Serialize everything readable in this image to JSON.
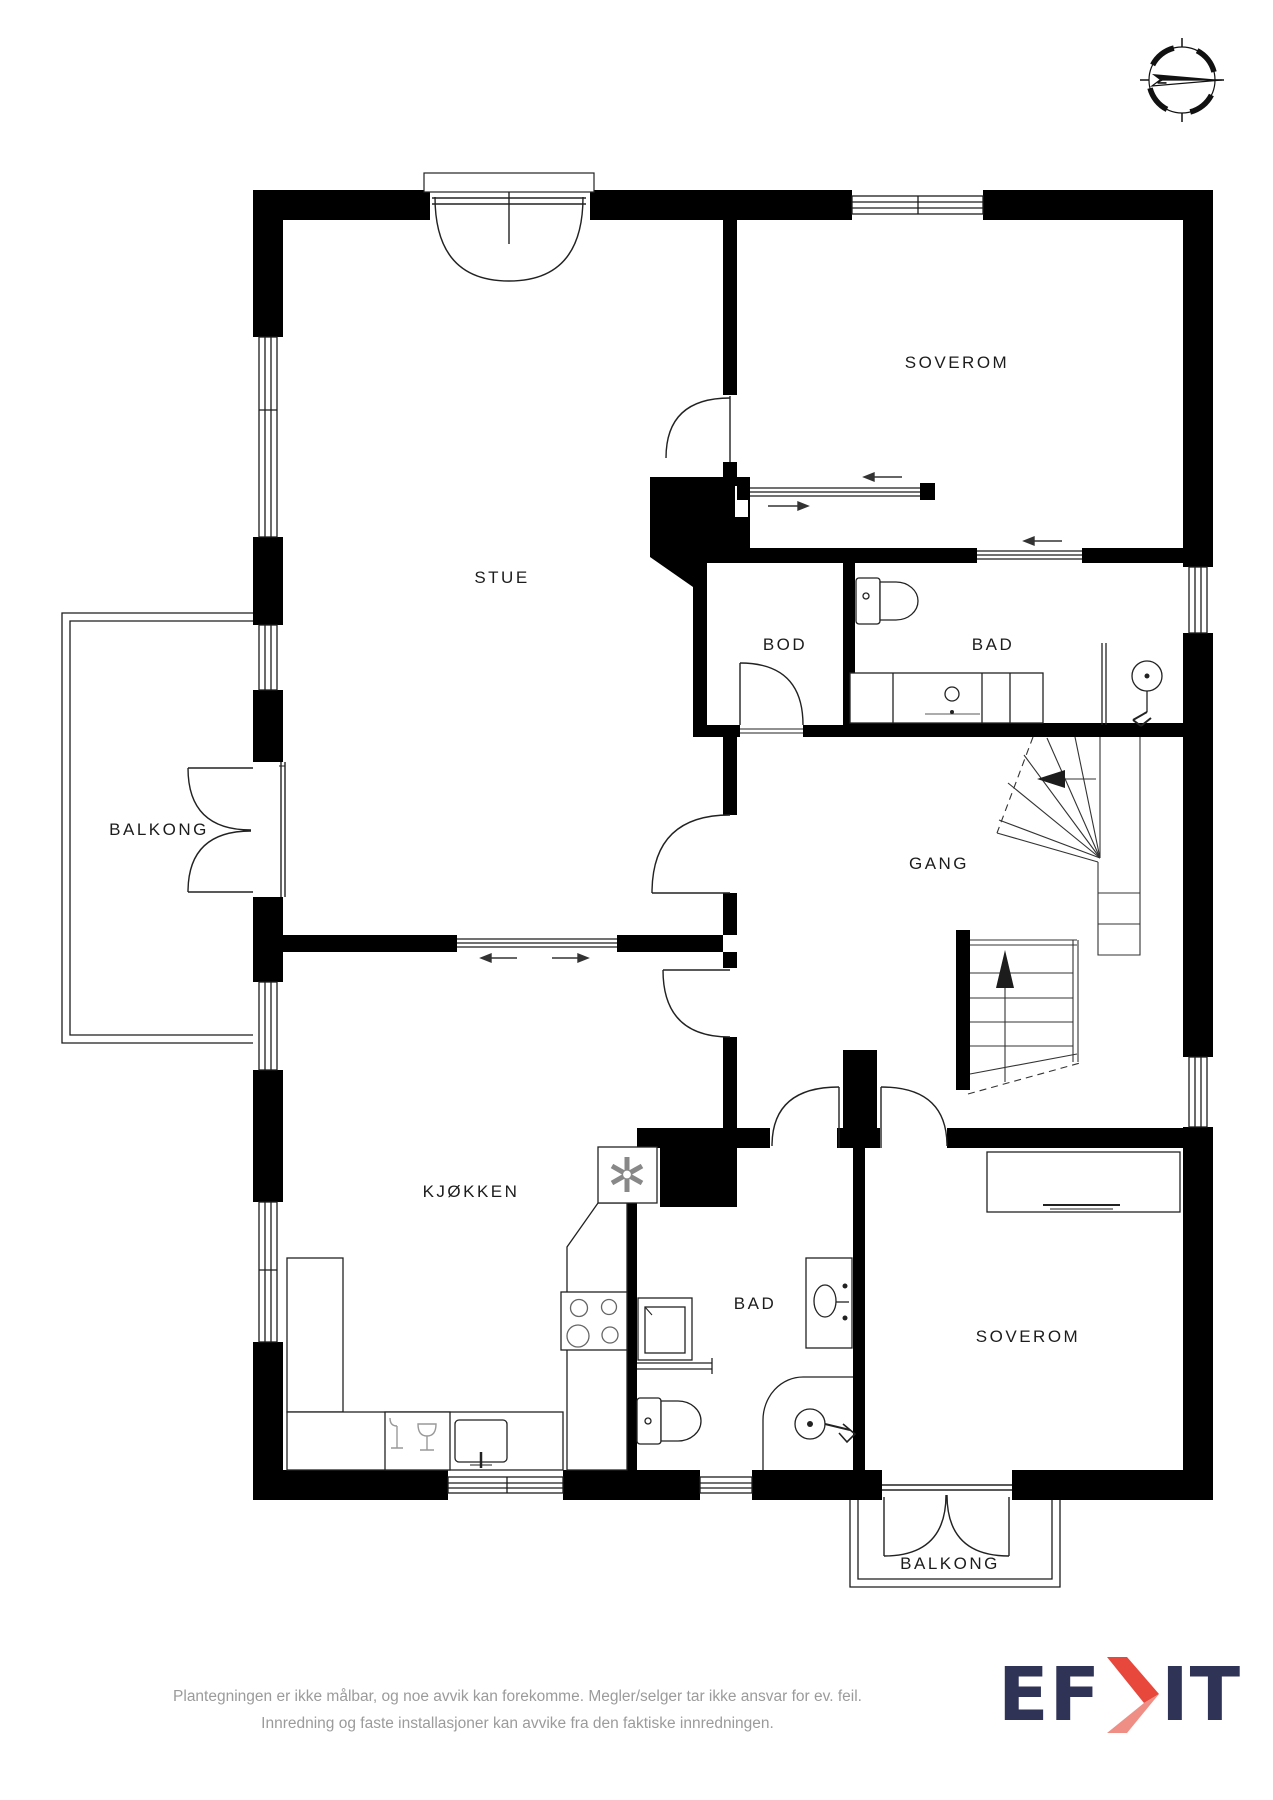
{
  "compass": {
    "north_label": "N"
  },
  "rooms": [
    {
      "id": "soverom-1",
      "label": "SOVEROM"
    },
    {
      "id": "stue",
      "label": "STUE"
    },
    {
      "id": "bod",
      "label": "BOD"
    },
    {
      "id": "bad-1",
      "label": "BAD"
    },
    {
      "id": "balkong-1",
      "label": "BALKONG"
    },
    {
      "id": "gang",
      "label": "GANG"
    },
    {
      "id": "kjokken",
      "label": "KJØKKEN"
    },
    {
      "id": "bad-2",
      "label": "BAD"
    },
    {
      "id": "soverom-2",
      "label": "SOVEROM"
    },
    {
      "id": "balkong-2",
      "label": "BALKONG"
    }
  ],
  "footer": {
    "line1": "Plantegningen er ikke målbar, og noe avvik kan forekomme. Megler/selger tar ikke ansvar for ev. feil.",
    "line2": "Innredning og faste installasjoner kan avvike fra den faktiske innredningen."
  },
  "logo": {
    "left": "EF",
    "right": "IT"
  },
  "colors": {
    "wall": "#000000",
    "line": "#1c1c1c",
    "fixture": "#555555",
    "navy": "#2f3355",
    "red": "#e8473b",
    "red_light": "#ef8e85",
    "footer_text": "#9b9b9b"
  }
}
